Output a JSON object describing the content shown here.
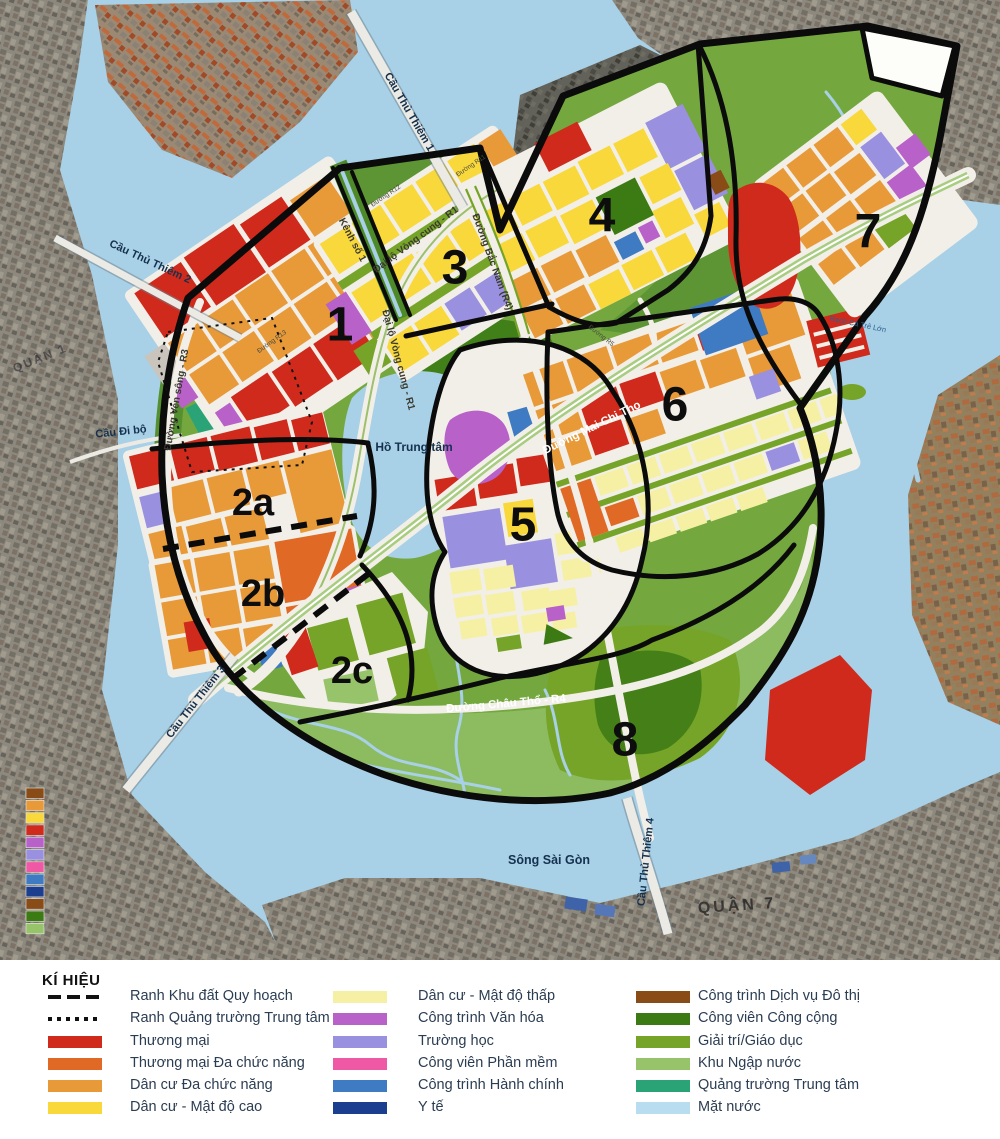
{
  "map": {
    "zone_labels": [
      {
        "id": "1",
        "x": 340,
        "y": 325
      },
      {
        "id": "2a",
        "x": 253,
        "y": 503
      },
      {
        "id": "2b",
        "x": 263,
        "y": 594
      },
      {
        "id": "2c",
        "x": 352,
        "y": 671
      },
      {
        "id": "3",
        "x": 455,
        "y": 268
      },
      {
        "id": "4",
        "x": 602,
        "y": 216
      },
      {
        "id": "5",
        "x": 523,
        "y": 525
      },
      {
        "id": "6",
        "x": 675,
        "y": 405
      },
      {
        "id": "7",
        "x": 868,
        "y": 232
      },
      {
        "id": "8",
        "x": 625,
        "y": 740
      }
    ],
    "place_labels": [
      {
        "text": "Cầu Thủ Thiêm 1",
        "x": 409,
        "y": 112,
        "r": 60,
        "cls": "bridge"
      },
      {
        "text": "Cầu Thủ Thiêm 2",
        "x": 150,
        "y": 262,
        "r": 25,
        "cls": "bridge"
      },
      {
        "text": "Cầu Đi bộ",
        "x": 121,
        "y": 432,
        "r": -6,
        "cls": "bridge"
      },
      {
        "text": "Cầu Thủ Thiêm 3",
        "x": 196,
        "y": 702,
        "r": -52,
        "cls": "bridge"
      },
      {
        "text": "Cầu Thủ Thiêm 4",
        "x": 646,
        "y": 862,
        "r": -84,
        "cls": "bridge"
      },
      {
        "text": "Sông Sài Gòn",
        "x": 549,
        "y": 860,
        "r": 0,
        "cls": "water-lg"
      },
      {
        "text": "Hồ Trung tâm",
        "x": 414,
        "y": 447,
        "r": 0,
        "cls": "water"
      },
      {
        "text": "QUẬN 7",
        "x": 737,
        "y": 906,
        "r": -4,
        "cls": "district"
      },
      {
        "text": "QUẬN 1",
        "x": 40,
        "y": 358,
        "r": -22,
        "cls": "district-faint"
      },
      {
        "text": "Kênh số 1",
        "x": 352,
        "y": 240,
        "r": 62,
        "cls": "road-dark"
      },
      {
        "text": "Đại lộ Vòng cung - R1",
        "x": 416,
        "y": 240,
        "r": -37,
        "cls": "road-dark"
      },
      {
        "text": "Đại lộ Vòng cung - R1",
        "x": 398,
        "y": 360,
        "r": 75,
        "cls": "road-dark"
      },
      {
        "text": "Đường Bắc Nam (R4)",
        "x": 492,
        "y": 262,
        "r": 70,
        "cls": "road-dark"
      },
      {
        "text": "Đường Ven sông - R3",
        "x": 177,
        "y": 400,
        "r": -80,
        "cls": "road-dark"
      },
      {
        "text": "Đường Mai Chi Thọ",
        "x": 592,
        "y": 428,
        "r": -26,
        "cls": "road-light"
      },
      {
        "text": "Đường Châu Thổ - R4",
        "x": 506,
        "y": 704,
        "r": -5,
        "cls": "road-light"
      },
      {
        "text": "Rạch Cá Trê Lớn",
        "x": 858,
        "y": 324,
        "r": 12,
        "cls": "water-sm"
      },
      {
        "text": "Đường R12",
        "x": 386,
        "y": 196,
        "r": -34,
        "cls": "road-tiny"
      },
      {
        "text": "Đường R11",
        "x": 471,
        "y": 166,
        "r": -34,
        "cls": "road-tiny"
      },
      {
        "text": "Đường R13",
        "x": 272,
        "y": 342,
        "r": -36,
        "cls": "road-tiny"
      },
      {
        "text": "Đường R5",
        "x": 601,
        "y": 336,
        "r": 38,
        "cls": "road-tiny"
      }
    ],
    "edge_strip_colors": [
      "#8a4c16",
      "#e89a38",
      "#f8d83a",
      "#cf2a1b",
      "#b861c9",
      "#9a90e0",
      "#ef58a5",
      "#3f7bc3",
      "#1b3f8e",
      "#8a4c16",
      "#3c7a14",
      "#97c46a"
    ]
  },
  "legend": {
    "title": "KÍ HIỆU",
    "columns": [
      {
        "items": [
          {
            "swatch": "dash",
            "label": "Ranh Khu đất Quy hoạch"
          },
          {
            "swatch": "dot",
            "label": "Ranh Quảng trường Trung tâm"
          },
          {
            "swatch": "#cf2a1b",
            "label": "Thương mại"
          },
          {
            "swatch": "#e06a25",
            "label": "Thương mại Đa chức năng"
          },
          {
            "swatch": "#e89a38",
            "label": "Dân cư Đa chức năng"
          },
          {
            "swatch": "#f8d83a",
            "label": "Dân cư - Mật độ cao"
          }
        ]
      },
      {
        "items": [
          {
            "swatch": "#f6f0a4",
            "label": "Dân cư - Mật độ thấp"
          },
          {
            "swatch": "#b861c9",
            "label": "Công trình Văn hóa"
          },
          {
            "swatch": "#9a90e0",
            "label": "Trường học"
          },
          {
            "swatch": "#ef58a5",
            "label": "Công viên Phần mềm"
          },
          {
            "swatch": "#3f7bc3",
            "label": "Công trình Hành chính"
          },
          {
            "swatch": "#1b3f8e",
            "label": "Y tế"
          }
        ]
      },
      {
        "items": [
          {
            "swatch": "#8a4c16",
            "label": "Công trình Dịch vụ Đô thị"
          },
          {
            "swatch": "#3c7a14",
            "label": "Công viên Công cộng"
          },
          {
            "swatch": "#76a428",
            "label": "Giải trí/Giáo dục"
          },
          {
            "swatch": "#97c46a",
            "label": "Khu Ngập nước"
          },
          {
            "swatch": "#2aa377",
            "label": "Quảng trường Trung tâm"
          },
          {
            "swatch": "#b8dcf0",
            "label": "Mặt nước"
          }
        ]
      }
    ]
  }
}
